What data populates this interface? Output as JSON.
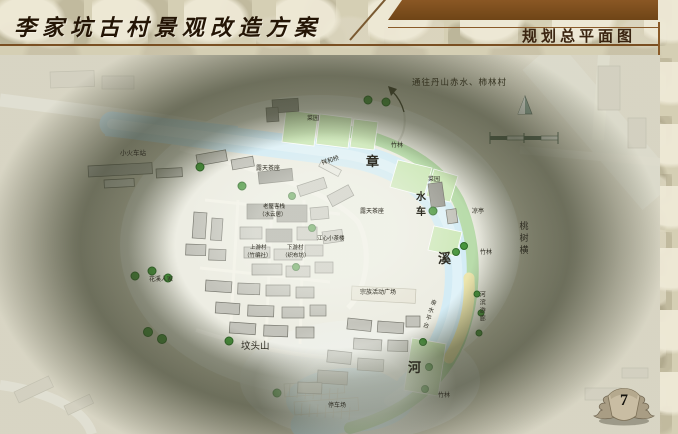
{
  "header": {
    "title": "李家坑古村景观改造方案",
    "section_title": "规划总平面图"
  },
  "page": {
    "number": "7"
  },
  "map": {
    "direction_note": "通往丹山赤水、柿林村",
    "labels": [
      {
        "text": "小火车站",
        "x": 120,
        "y": 151,
        "size": 6.5
      },
      {
        "text": "露天茶座",
        "x": 256,
        "y": 166,
        "size": 6
      },
      {
        "text": "祥和桥",
        "x": 321,
        "y": 161,
        "size": 6,
        "rotate": -18
      },
      {
        "text": "章",
        "x": 366,
        "y": 155,
        "size": 13,
        "bold": true
      },
      {
        "text": "菜园",
        "x": 307,
        "y": 116,
        "size": 6
      },
      {
        "text": "竹林",
        "x": 391,
        "y": 143,
        "size": 6
      },
      {
        "text": "菜园",
        "x": 428,
        "y": 177,
        "size": 6
      },
      {
        "text": "水车",
        "x": 413,
        "y": 191,
        "size": 10,
        "bold": true,
        "vertical": true,
        "spacing": 5
      },
      {
        "text": "凉亭",
        "x": 472,
        "y": 209,
        "size": 6
      },
      {
        "text": "露天茶座",
        "x": 360,
        "y": 209,
        "size": 6
      },
      {
        "text": "桃树横",
        "x": 518,
        "y": 221,
        "size": 9,
        "vertical": true,
        "spacing": 3
      },
      {
        "text": "竹林",
        "x": 480,
        "y": 250,
        "size": 6
      },
      {
        "text": "溪",
        "x": 438,
        "y": 252,
        "size": 13,
        "bold": true
      },
      {
        "text": "花溪人家",
        "x": 149,
        "y": 277,
        "size": 6
      },
      {
        "text": "老屋客栈",
        "x": 263,
        "y": 205,
        "size": 5.5
      },
      {
        "text": "（水云居）",
        "x": 259,
        "y": 213,
        "size": 5.5
      },
      {
        "text": "上游村",
        "x": 250,
        "y": 246,
        "size": 5.5
      },
      {
        "text": "（竹编社）",
        "x": 244,
        "y": 254,
        "size": 5.5
      },
      {
        "text": "下游村",
        "x": 287,
        "y": 246,
        "size": 5.5
      },
      {
        "text": "（织布坊）",
        "x": 282,
        "y": 254,
        "size": 5.5
      },
      {
        "text": "江心小茶楼",
        "x": 317,
        "y": 237,
        "size": 5.5
      },
      {
        "text": "坟头山",
        "x": 241,
        "y": 343,
        "size": 9.5
      },
      {
        "text": "宗族活动广场",
        "x": 360,
        "y": 290,
        "size": 6
      },
      {
        "text": "亲水平台",
        "x": 430,
        "y": 298,
        "size": 6,
        "vertical": true,
        "rotate": 18
      },
      {
        "text": "河滨游廊",
        "x": 478,
        "y": 291,
        "size": 6,
        "vertical": true
      },
      {
        "text": "河",
        "x": 408,
        "y": 361,
        "size": 13,
        "bold": true
      },
      {
        "text": "停车场",
        "x": 328,
        "y": 403,
        "size": 6
      },
      {
        "text": "竹林",
        "x": 438,
        "y": 393,
        "size": 6
      }
    ],
    "icons": {
      "north_arrow": "▲",
      "route_arrow": "↖",
      "scale_bar": "segmented-scale",
      "page_emblem": "winged-stone"
    },
    "colors": {
      "banner_brown": "#7b4e1f",
      "rule_brown": "#8a5a28",
      "river_blue": "#d4ecf5",
      "bank_green": "#b9dcab",
      "field_green": "#cfe9bb",
      "promenade_yellow": "#ece5ad",
      "tree_green": "#47953c",
      "vignette_olive": "#3a3e28"
    }
  }
}
